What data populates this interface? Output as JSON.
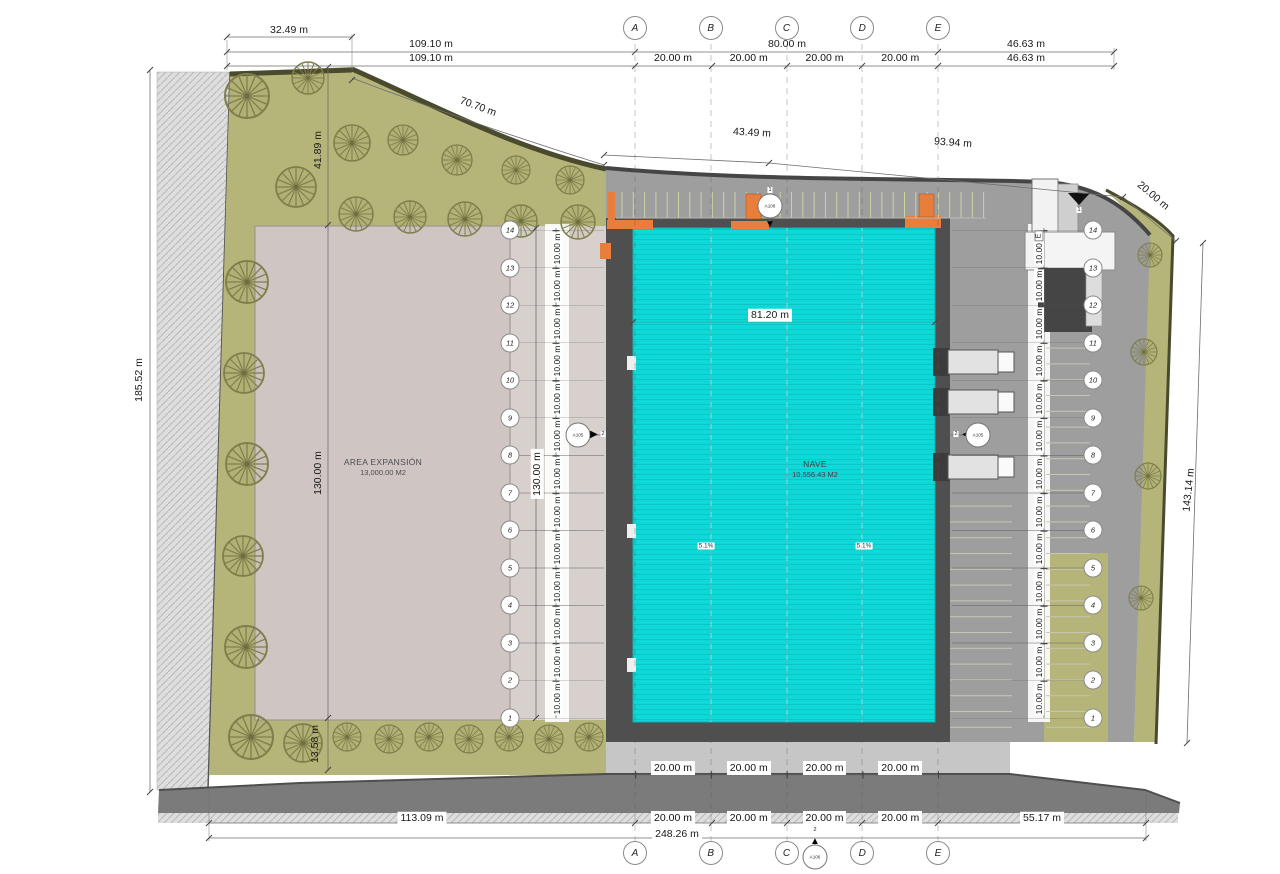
{
  "colors": {
    "cyan": "#0ed8d8",
    "olive": "#b5b57a",
    "expansion": "#cfc6c4",
    "corridor": "#d8d0cd",
    "yard": "#9e9e9e",
    "apron": "#4f4f4f",
    "road": "#7b7b7b",
    "orange": "#e87d3c",
    "edge": "#4a4a2e"
  },
  "grid": {
    "columns": [
      "A",
      "B",
      "C",
      "D",
      "E"
    ],
    "rows": [
      "14",
      "13",
      "12",
      "11",
      "10",
      "9",
      "8",
      "7",
      "6",
      "5",
      "4",
      "3",
      "2",
      "1"
    ]
  },
  "buildings": {
    "nave": {
      "name": "NAVE",
      "area": "10,556.43 M2",
      "width": "81.20 m",
      "slope_left": "5.1%",
      "slope_right": "5.1%"
    },
    "expansion": {
      "name": "AREA EXPANSIÓN",
      "area": "13,000.00 M2"
    }
  },
  "dims": {
    "top": {
      "d32": "32.49 m",
      "d109_1": "109.10 m",
      "d109_2": "109.10 m",
      "d80": "80.00 m",
      "d46_1": "46.63 m",
      "d46_2": "46.63 m",
      "bays": [
        "20.00 m",
        "20.00 m",
        "20.00 m",
        "20.00 m"
      ]
    },
    "site": {
      "d70": "70.70 m",
      "d43": "43.49 m",
      "d93": "93.94 m",
      "d20corner": "20.00 m",
      "d185": "185.52 m",
      "d41": "41.89 m",
      "d13": "13.58 m",
      "d143": "143.14 m"
    },
    "vertical": {
      "d130_1": "130.00 m",
      "d130_2": "130.00 m",
      "left_chain": [
        "10.00 m",
        "10.00 m",
        "10.00 m",
        "10.00 m",
        "10.00 m",
        "10.00 m",
        "10.00 m",
        "10.00 m",
        "10.00 m",
        "10.00 m",
        "10.00 m",
        "10.00 m",
        "10.00 m"
      ],
      "right_chain": [
        "10.00 m",
        "10.00 m",
        "10.00 m",
        "10.00 m",
        "10.00 m",
        "10.00 m",
        "10.00 m",
        "10.00 m",
        "10.00 m",
        "10.00 m",
        "10.00 m",
        "10.00 m",
        "10.00 m"
      ]
    },
    "bottom": {
      "bays1": [
        "20.00 m",
        "20.00 m",
        "20.00 m",
        "20.00 m"
      ],
      "bays2": [
        "20.00 m",
        "20.00 m",
        "20.00 m",
        "20.00 m"
      ],
      "d113": "113.09 m",
      "d55": "55.17 m",
      "d248": "248.26 m"
    }
  },
  "markers": {
    "section_top": {
      "sheet": "A106",
      "num": "1"
    },
    "section_bottom": {
      "sheet": "A106",
      "num": "2"
    },
    "section_left": {
      "sheet": "A105",
      "num": "2"
    },
    "section_right": {
      "sheet": "A105",
      "num": "2"
    },
    "entry": {
      "num": "1"
    },
    "wall_label_e": "E"
  }
}
